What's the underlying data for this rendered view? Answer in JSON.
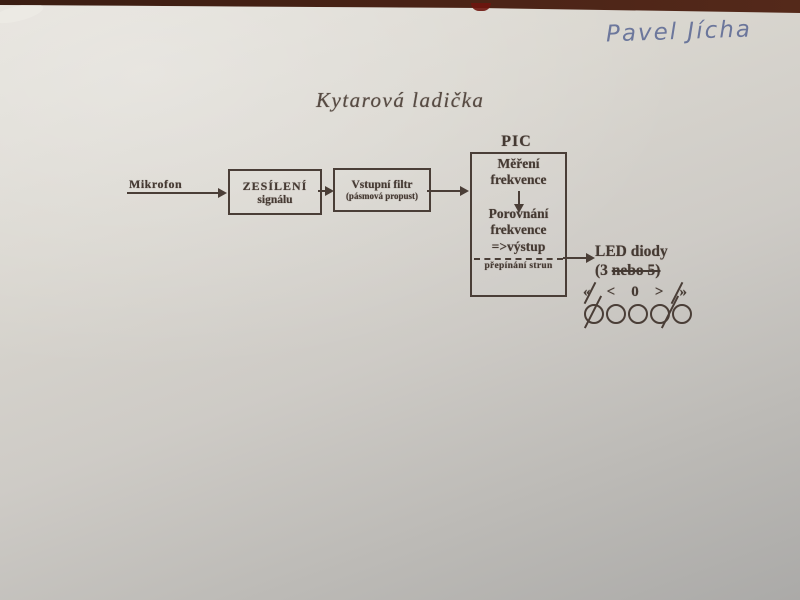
{
  "photo": {
    "handwritten_name": "Pavel Jícha",
    "ink_color": "#5d6a95",
    "table_color": "#4a2316",
    "paper_color": "#d9d6cf",
    "print_color": "#453a33"
  },
  "diagram": {
    "title": "Kytarová ladička",
    "input_label": "Mikrofon",
    "amp_block": {
      "line1": "ZESÍLENÍ",
      "line2": "signálu"
    },
    "filter_block": {
      "line1": "Vstupní filtr",
      "line2": "(pásmová propust)"
    },
    "pic_block": {
      "label": "PIC",
      "step1_line1": "Měření",
      "step1_line2": "frekvence",
      "step2_line1": "Porovnání",
      "step2_line2": "frekvence",
      "output_line": "=>výstup",
      "bottom_line": "přepínání strun"
    },
    "led": {
      "title": "LED diody",
      "count_prefix": "(3 ",
      "count_struck": "nebo 5)",
      "symbols": [
        "«",
        "<",
        "0",
        ">",
        "»"
      ],
      "circle_count": 5
    }
  }
}
